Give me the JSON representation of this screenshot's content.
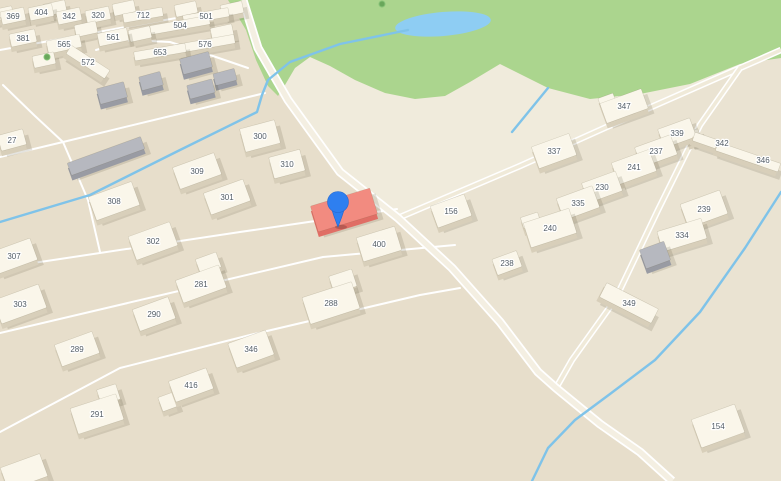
{
  "map": {
    "colors": {
      "base": "#eae3d2",
      "left_area": "#e7decb",
      "field": "#f0ebdc",
      "park": "#abd58e",
      "pond": "#8ecdf3",
      "stream": "#7fc3e9",
      "road_casing": "#ffffff",
      "road_main": "#f4efe2",
      "road_sec": "#f0ead9",
      "label": "#535d66",
      "pin_blue": "#2e7ff0",
      "cream": {
        "top": "#faf6ea",
        "side": "#d8cfba"
      },
      "gray": {
        "top": "#b6b8bf",
        "side": "#999ba3"
      },
      "red": {
        "top": "#f28b80",
        "side": "#e06e65"
      }
    },
    "left_area_poly": [
      [
        0,
        0
      ],
      [
        243,
        0
      ],
      [
        258,
        48
      ],
      [
        288,
        100
      ],
      [
        340,
        172
      ],
      [
        398,
        218
      ],
      [
        452,
        268
      ],
      [
        500,
        322
      ],
      [
        538,
        372
      ],
      [
        600,
        424
      ],
      [
        672,
        481
      ],
      [
        0,
        481
      ]
    ],
    "field_poly": [
      [
        243,
        0
      ],
      [
        258,
        48
      ],
      [
        288,
        100
      ],
      [
        340,
        172
      ],
      [
        398,
        218
      ],
      [
        640,
        112
      ],
      [
        740,
        68
      ],
      [
        781,
        48
      ],
      [
        781,
        0
      ]
    ],
    "park": {
      "outline": [
        [
          228,
          0
        ],
        [
          781,
          0
        ],
        [
          781,
          58
        ],
        [
          740,
          64
        ],
        [
          690,
          84
        ],
        [
          640,
          94
        ],
        [
          590,
          99
        ],
        [
          548,
          88
        ],
        [
          520,
          74
        ],
        [
          500,
          64
        ],
        [
          470,
          82
        ],
        [
          445,
          96
        ],
        [
          415,
          99
        ],
        [
          385,
          93
        ],
        [
          355,
          80
        ],
        [
          330,
          66
        ],
        [
          310,
          57
        ],
        [
          295,
          68
        ],
        [
          285,
          85
        ],
        [
          278,
          96
        ],
        [
          268,
          86
        ],
        [
          256,
          60
        ],
        [
          246,
          30
        ]
      ],
      "pond": {
        "cx": 443,
        "cy": 24,
        "rx": 48,
        "ry": 12,
        "rot": -5
      }
    },
    "roads": [
      {
        "type": "lane",
        "pts": [
          [
            0,
            50
          ],
          [
            120,
            28
          ],
          [
            244,
            6
          ]
        ]
      },
      {
        "type": "lane",
        "pts": [
          [
            0,
            157
          ],
          [
            63,
            142
          ],
          [
            187,
            112
          ],
          [
            265,
            93
          ]
        ]
      },
      {
        "type": "lane",
        "pts": [
          [
            3,
            85
          ],
          [
            35,
            116
          ],
          [
            63,
            142
          ],
          [
            88,
            200
          ],
          [
            100,
            252
          ]
        ]
      },
      {
        "type": "lane",
        "pts": [
          [
            96,
            50
          ],
          [
            130,
            40
          ],
          [
            170,
            42
          ],
          [
            210,
            55
          ],
          [
            248,
            68
          ]
        ]
      },
      {
        "type": "lane",
        "pts": [
          [
            0,
            268
          ],
          [
            240,
            232
          ],
          [
            397,
            209
          ]
        ]
      },
      {
        "type": "lane",
        "pts": [
          [
            0,
            333
          ],
          [
            200,
            286
          ],
          [
            323,
            257
          ],
          [
            455,
            245
          ]
        ]
      },
      {
        "type": "lane",
        "pts": [
          [
            0,
            432
          ],
          [
            120,
            368
          ],
          [
            250,
            335
          ],
          [
            420,
            295
          ],
          [
            460,
            288
          ]
        ]
      },
      {
        "type": "sec",
        "pts": [
          [
            398,
            218
          ],
          [
            520,
            166
          ],
          [
            640,
            112
          ],
          [
            740,
            68
          ],
          [
            781,
            50
          ]
        ]
      },
      {
        "type": "sec",
        "pts": [
          [
            740,
            68
          ],
          [
            700,
            125
          ],
          [
            658,
            210
          ],
          [
            615,
            300
          ],
          [
            572,
            360
          ],
          [
            556,
            388
          ]
        ]
      },
      {
        "type": "main",
        "pts": [
          [
            243,
            0
          ],
          [
            258,
            48
          ],
          [
            288,
            100
          ],
          [
            340,
            172
          ],
          [
            398,
            218
          ],
          [
            452,
            268
          ],
          [
            500,
            322
          ],
          [
            538,
            372
          ],
          [
            556,
            388
          ],
          [
            600,
            424
          ],
          [
            640,
            452
          ],
          [
            672,
            481
          ]
        ]
      }
    ],
    "streams": [
      [
        [
          408,
          30
        ],
        [
          340,
          44
        ],
        [
          290,
          62
        ],
        [
          268,
          80
        ],
        [
          262,
          95
        ],
        [
          257,
          112
        ],
        [
          180,
          150
        ],
        [
          90,
          195
        ],
        [
          0,
          222
        ]
      ],
      [
        [
          781,
          192
        ],
        [
          745,
          248
        ],
        [
          700,
          312
        ],
        [
          655,
          360
        ],
        [
          610,
          394
        ],
        [
          575,
          420
        ],
        [
          548,
          448
        ],
        [
          532,
          481
        ]
      ],
      [
        [
          548,
          88
        ],
        [
          530,
          110
        ],
        [
          512,
          132
        ]
      ]
    ],
    "buildings": [
      {
        "label": "369",
        "x": 13,
        "y": 16,
        "w": 24,
        "h": 13,
        "a": -12
      },
      {
        "label": "404",
        "x": 41,
        "y": 12,
        "w": 24,
        "h": 13,
        "a": -12
      },
      {
        "label": "342",
        "x": 69,
        "y": 16,
        "w": 24,
        "h": 13,
        "a": -12
      },
      {
        "label": "320",
        "x": 98,
        "y": 15,
        "w": 24,
        "h": 13,
        "a": -12
      },
      {
        "label": "712",
        "x": 143,
        "y": 15,
        "w": 40,
        "h": 9,
        "a": -10
      },
      {
        "label": "501",
        "x": 206,
        "y": 16,
        "w": 46,
        "h": 9,
        "a": -10
      },
      {
        "label": "504",
        "x": 180,
        "y": 25,
        "w": 60,
        "h": 9,
        "a": -10
      },
      {
        "label": "381",
        "x": 23,
        "y": 38,
        "w": 26,
        "h": 13,
        "a": -12
      },
      {
        "label": "565",
        "x": 64,
        "y": 44,
        "w": 34,
        "h": 13,
        "a": -12
      },
      {
        "label": "561",
        "x": 113,
        "y": 37,
        "w": 30,
        "h": 13,
        "a": -12
      },
      {
        "label": "576",
        "x": 205,
        "y": 44,
        "w": 60,
        "h": 9,
        "a": -10
      },
      {
        "label": "653",
        "x": 160,
        "y": 52,
        "w": 52,
        "h": 9,
        "a": -10
      },
      {
        "label": "572",
        "x": 88,
        "y": 62,
        "w": 46,
        "h": 10,
        "a": 33
      },
      {
        "label": "27",
        "x": 12,
        "y": 140,
        "w": 26,
        "h": 16,
        "a": -15
      },
      {
        "x": 55,
        "y": 8,
        "w": 22,
        "h": 12,
        "a": -12
      },
      {
        "x": 124,
        "y": 8,
        "w": 22,
        "h": 12,
        "a": -12
      },
      {
        "x": 186,
        "y": 9,
        "w": 22,
        "h": 12,
        "a": -12
      },
      {
        "x": 232,
        "y": 9,
        "w": 22,
        "h": 12,
        "a": -12
      },
      {
        "x": 86,
        "y": 29,
        "w": 22,
        "h": 12,
        "a": -12
      },
      {
        "x": 140,
        "y": 34,
        "w": 22,
        "h": 12,
        "a": -12
      },
      {
        "x": 44,
        "y": 60,
        "w": 22,
        "h": 12,
        "a": -12
      },
      {
        "x": 2,
        "y": 14,
        "w": 22,
        "h": 12,
        "a": -12
      },
      {
        "x": 222,
        "y": 32,
        "w": 22,
        "h": 12,
        "a": -12
      },
      {
        "x": 112,
        "y": 93,
        "w": 28,
        "h": 16,
        "a": -15,
        "color": "gray"
      },
      {
        "x": 151,
        "y": 81,
        "w": 22,
        "h": 14,
        "a": -15,
        "color": "gray"
      },
      {
        "x": 196,
        "y": 63,
        "w": 30,
        "h": 16,
        "a": -15,
        "color": "gray"
      },
      {
        "x": 201,
        "y": 89,
        "w": 26,
        "h": 14,
        "a": -15,
        "color": "gray"
      },
      {
        "x": 225,
        "y": 77,
        "w": 22,
        "h": 12,
        "a": -15,
        "color": "gray"
      },
      {
        "x": 106,
        "y": 156,
        "w": 78,
        "h": 13,
        "a": -20,
        "color": "gray"
      },
      {
        "x": 655,
        "y": 255,
        "w": 26,
        "h": 20,
        "a": -20,
        "color": "gray"
      },
      {
        "label": "300",
        "x": 260,
        "y": 136,
        "w": 36,
        "h": 24,
        "a": -15
      },
      {
        "label": "310",
        "x": 287,
        "y": 164,
        "w": 32,
        "h": 22,
        "a": -15
      },
      {
        "label": "309",
        "x": 197,
        "y": 171,
        "w": 44,
        "h": 23,
        "a": -20
      },
      {
        "label": "301",
        "x": 227,
        "y": 197,
        "w": 42,
        "h": 23,
        "a": -20
      },
      {
        "label": "308",
        "x": 114,
        "y": 201,
        "w": 46,
        "h": 25,
        "a": -20
      },
      {
        "label": "302",
        "x": 153,
        "y": 241,
        "w": 44,
        "h": 25,
        "a": -20
      },
      {
        "label": "307",
        "x": 14,
        "y": 256,
        "w": 42,
        "h": 23,
        "a": -20
      },
      {
        "label": "303",
        "x": 20,
        "y": 304,
        "w": 48,
        "h": 25,
        "a": -20
      },
      {
        "label": "290",
        "x": 154,
        "y": 314,
        "w": 38,
        "h": 23,
        "a": -20
      },
      {
        "label": "281",
        "x": 201,
        "y": 284,
        "w": 46,
        "h": 24,
        "a": -20,
        "wing": {
          "dx": 14,
          "dy": -17,
          "w": 22,
          "h": 16
        }
      },
      {
        "label": "289",
        "x": 77,
        "y": 349,
        "w": 40,
        "h": 23,
        "a": -20
      },
      {
        "label": "288",
        "x": 331,
        "y": 303,
        "w": 52,
        "h": 28,
        "a": -18,
        "wing": {
          "dx": 18,
          "dy": -17,
          "w": 24,
          "h": 18
        }
      },
      {
        "label": "346",
        "x": 251,
        "y": 349,
        "w": 40,
        "h": 26,
        "a": -20
      },
      {
        "label": "416",
        "x": 191,
        "y": 385,
        "w": 40,
        "h": 22,
        "a": -20,
        "wing": {
          "dx": -28,
          "dy": 8,
          "w": 15,
          "h": 15
        }
      },
      {
        "label": "291",
        "x": 97,
        "y": 414,
        "w": 48,
        "h": 27,
        "a": -18,
        "wing": {
          "dx": 17,
          "dy": -15,
          "w": 20,
          "h": 16
        }
      },
      {
        "label": "400",
        "x": 379,
        "y": 244,
        "w": 40,
        "h": 25,
        "a": -17
      },
      {
        "x": 24,
        "y": 472,
        "w": 42,
        "h": 24,
        "a": -20
      },
      {
        "x": 344,
        "y": 210,
        "w": 62,
        "h": 27,
        "a": -17,
        "color": "red"
      },
      {
        "label": "156",
        "x": 451,
        "y": 211,
        "w": 36,
        "h": 23,
        "a": -20
      },
      {
        "label": "337",
        "x": 554,
        "y": 151,
        "w": 40,
        "h": 23,
        "a": -20
      },
      {
        "label": "347",
        "x": 624,
        "y": 106,
        "w": 44,
        "h": 21,
        "a": -20,
        "wing": {
          "dx": -14,
          "dy": -9,
          "w": 16,
          "h": 14
        }
      },
      {
        "label": "339",
        "x": 677,
        "y": 133,
        "w": 34,
        "h": 20,
        "a": -20,
        "wing": {
          "dx": 14,
          "dy": 9,
          "w": 14,
          "h": 12
        }
      },
      {
        "label": "237",
        "x": 656,
        "y": 151,
        "w": 38,
        "h": 21,
        "a": -20
      },
      {
        "label": "241",
        "x": 634,
        "y": 167,
        "w": 40,
        "h": 23,
        "a": -20
      },
      {
        "label": "230",
        "x": 602,
        "y": 187,
        "w": 36,
        "h": 21,
        "a": -20
      },
      {
        "label": "335",
        "x": 578,
        "y": 203,
        "w": 38,
        "h": 23,
        "a": -20
      },
      {
        "label": "240",
        "x": 550,
        "y": 228,
        "w": 48,
        "h": 26,
        "a": -18,
        "wing": {
          "dx": -16,
          "dy": -12,
          "w": 18,
          "h": 14
        }
      },
      {
        "label": "238",
        "x": 507,
        "y": 263,
        "w": 26,
        "h": 17,
        "a": -20
      },
      {
        "label": "239",
        "x": 704,
        "y": 209,
        "w": 42,
        "h": 25,
        "a": -20
      },
      {
        "label": "334",
        "x": 682,
        "y": 235,
        "w": 46,
        "h": 21,
        "a": -17
      },
      {
        "label": "349",
        "x": 629,
        "y": 303,
        "w": 58,
        "h": 16,
        "a": 27
      },
      {
        "label": "154",
        "x": 718,
        "y": 426,
        "w": 46,
        "h": 30,
        "a": -20
      },
      {
        "x": 707,
        "y": 141,
        "w": 28,
        "h": 9,
        "a": 19
      },
      {
        "x": 748,
        "y": 157,
        "w": 66,
        "h": 9,
        "a": 19
      }
    ],
    "extra_labels": [
      {
        "text": "342",
        "x": 722,
        "y": 143
      },
      {
        "text": "346",
        "x": 763,
        "y": 160
      }
    ],
    "trees": [
      {
        "x": 382,
        "y": 4
      },
      {
        "x": 47,
        "y": 57
      }
    ],
    "pin": {
      "x": 338,
      "y": 202
    }
  }
}
